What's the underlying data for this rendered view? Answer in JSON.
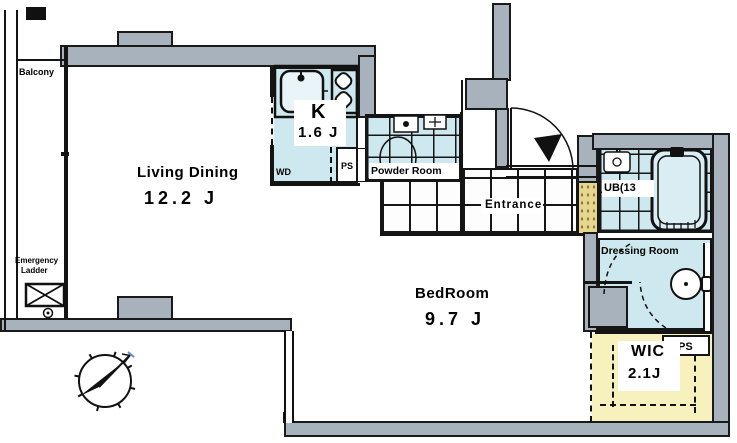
{
  "rooms": {
    "balcony": {
      "label": "Balcony"
    },
    "living_dining": {
      "label": "Living Dining",
      "size": "12.2 J"
    },
    "kitchen": {
      "label": "K",
      "size": "1.6 J"
    },
    "powder_room": {
      "label": "Powder Room"
    },
    "entrance": {
      "label": "Entrance"
    },
    "bedroom": {
      "label": "BedRoom",
      "size": "9.7 J"
    },
    "unit_bath": {
      "label": "UB(13"
    },
    "dressing_room": {
      "label": "Dressing Room"
    },
    "wic": {
      "label": "WIC",
      "size": "2.1J"
    }
  },
  "annotations": {
    "emergency_ladder": {
      "line1": "Emergency",
      "line2": "Ladder"
    },
    "washer_dryer": "WD",
    "pipe_space_kitchen": "PS",
    "pipe_space_wic": "PS"
  },
  "colors": {
    "wall": "#a8b2bc",
    "wet_area_floor": "#cde8ee",
    "wic_floor": "#f7f1bd",
    "entry_mat": "#e8d88e",
    "line": "#161616"
  }
}
